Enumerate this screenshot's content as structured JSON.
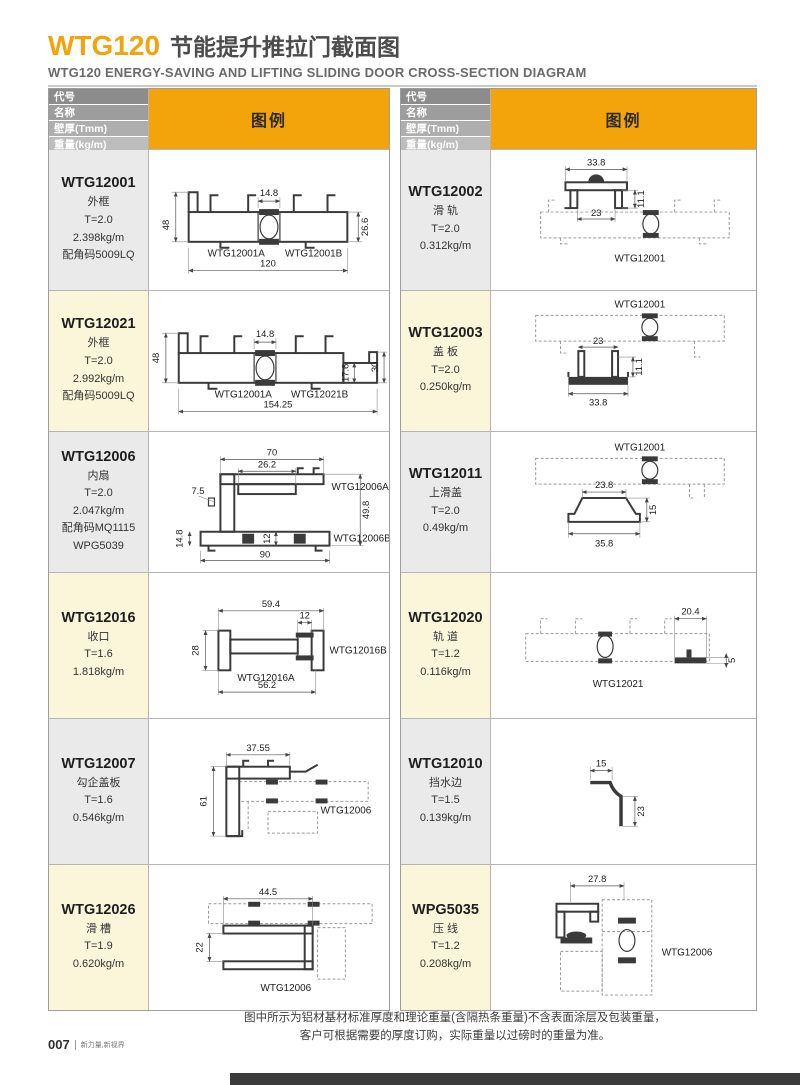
{
  "page": {
    "title_code": "WTG120",
    "title_zh": "节能提升推拉门截面图",
    "subtitle_en": "WTG120 ENERGY-SAVING AND LIFTING SLIDING DOOR CROSS-SECTION DIAGRAM",
    "footnote_line1": "图中所示为铝材基材标准厚度和理论重量(含隔热条重量)不含表面涂层及包装重量，",
    "footnote_line2": "客户可根据需要的厚度订购，实际重量以过磅时的重量为准。",
    "page_number": "007",
    "tagline": "新力量,新视界"
  },
  "colors": {
    "accent": "#F2A40A",
    "header_grays": [
      "#8c8c8c",
      "#9d9d9d",
      "#aeaeae",
      "#bdbdbd"
    ],
    "row_gray": "#EAEAEA",
    "row_yellow": "#FBF6DA"
  },
  "table_header": {
    "labels": [
      "代号",
      "名称",
      "壁厚(Tmm)",
      "重量(kg/m)"
    ],
    "legend": "图例"
  },
  "rows": {
    "l1": {
      "code": "WTG12001",
      "name": "外框",
      "spec": "T=2.0",
      "weight": "2.398kg/m",
      "note1": "配角码5009LQ",
      "dims": {
        "d1": "48",
        "d2": "14.8",
        "d3": "26.6",
        "d4": "120"
      },
      "labels": {
        "a": "WTG12001A",
        "b": "WTG12001B"
      }
    },
    "l2": {
      "code": "WTG12021",
      "name": "外框",
      "spec": "T=2.0",
      "weight": "2.992kg/m",
      "note1": "配角码5009LQ",
      "dims": {
        "d1": "48",
        "d2": "14.8",
        "d3": "17.6",
        "d4": "30",
        "d5": "154.25"
      },
      "labels": {
        "a": "WTG12001A",
        "b": "WTG12021B"
      }
    },
    "l3": {
      "code": "WTG12006",
      "name": "内扇",
      "spec": "T=2.0",
      "weight": "2.047kg/m",
      "note1": "配角码MQ1115",
      "note2": "WPG5039",
      "dims": {
        "d1": "70",
        "d2": "26.2",
        "d3": "7.5",
        "d4": "14.8",
        "d5": "12",
        "d6": "49.8",
        "d7": "90"
      },
      "labels": {
        "a": "WTG12006A",
        "b": "WTG12006B"
      }
    },
    "l4": {
      "code": "WTG12016",
      "name": "收口",
      "spec": "T=1.6",
      "weight": "1.818kg/m",
      "dims": {
        "d1": "59.4",
        "d2": "12",
        "d3": "28",
        "d4": "56.2"
      },
      "labels": {
        "a": "WTG12016A",
        "b": "WTG12016B"
      }
    },
    "l5": {
      "code": "WTG12007",
      "name": "勾企盖板",
      "spec": "T=1.6",
      "weight": "0.546kg/m",
      "dims": {
        "d1": "37.55",
        "d2": "61"
      },
      "labels": {
        "ctx": "WTG12006"
      }
    },
    "l6": {
      "code": "WTG12026",
      "name": "滑 槽",
      "spec": "T=1.9",
      "weight": "0.620kg/m",
      "dims": {
        "d1": "44.5",
        "d2": "22"
      },
      "labels": {
        "ctx": "WTG12006"
      }
    },
    "r1": {
      "code": "WTG12002",
      "name": "滑 轨",
      "spec": "T=2.0",
      "weight": "0.312kg/m",
      "dims": {
        "d1": "33.8",
        "d2": "11.1",
        "d3": "23"
      },
      "labels": {
        "ctx": "WTG12001"
      }
    },
    "r2": {
      "code": "WTG12003",
      "name": "盖 板",
      "spec": "T=2.0",
      "weight": "0.250kg/m",
      "dims": {
        "d1": "23",
        "d2": "11.1",
        "d3": "33.8"
      },
      "labels": {
        "ctx": "WTG12001"
      }
    },
    "r3": {
      "code": "WTG12011",
      "name": "上滑盖",
      "spec": "T=2.0",
      "weight": "0.49kg/m",
      "dims": {
        "d1": "23.8",
        "d2": "15",
        "d3": "35.8"
      },
      "labels": {
        "ctx": "WTG12001"
      }
    },
    "r4": {
      "code": "WTG12020",
      "name": "轨 道",
      "spec": "T=1.2",
      "weight": "0.116kg/m",
      "dims": {
        "d1": "20.4",
        "d2": "5"
      },
      "labels": {
        "ctx": "WTG12021"
      }
    },
    "r5": {
      "code": "WTG12010",
      "name": "挡水边",
      "spec": "T=1.5",
      "weight": "0.139kg/m",
      "dims": {
        "d1": "15",
        "d2": "23"
      }
    },
    "r6": {
      "code": "WPG5035",
      "name": "压 线",
      "spec": "T=1.2",
      "weight": "0.208kg/m",
      "dims": {
        "d1": "27.8"
      },
      "labels": {
        "ctx": "WTG12006"
      }
    }
  }
}
